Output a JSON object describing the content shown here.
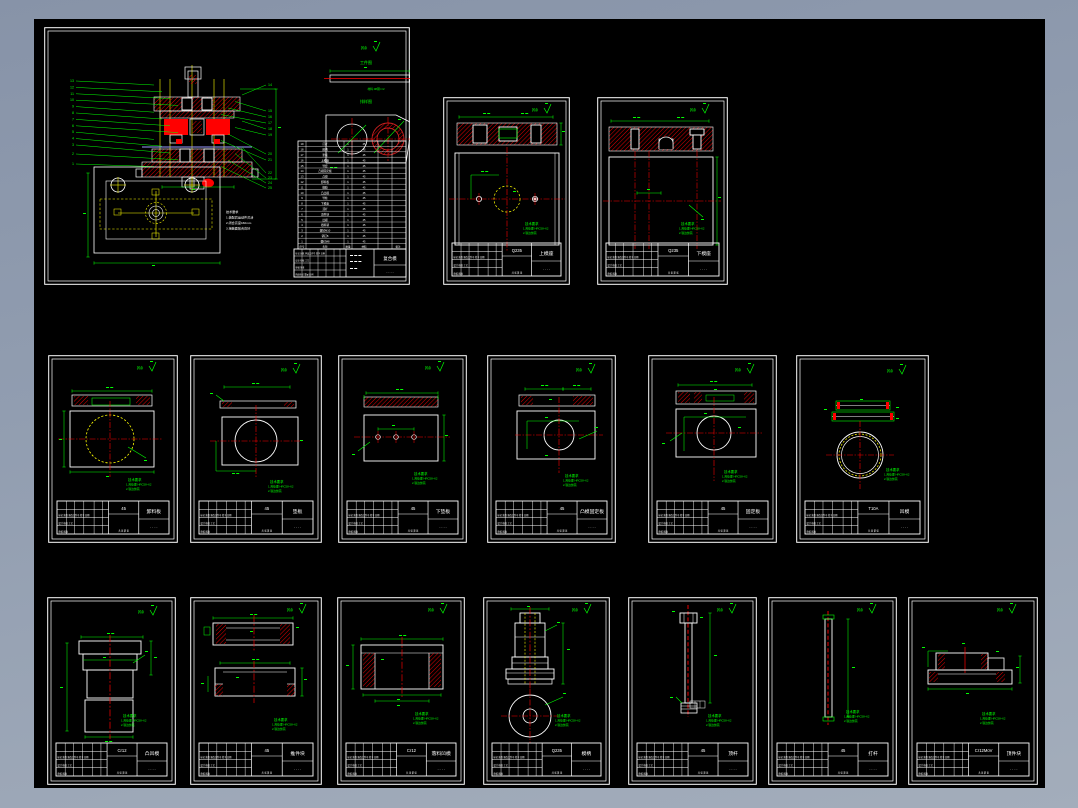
{
  "app": {
    "name": "cad-drawing-preview",
    "background_top": "#8793a8",
    "background_bottom": "#a3adbb",
    "paper_color": "#000000"
  },
  "colors": {
    "line": "#ffffff",
    "dim": "#00ff00",
    "center": "#ff0000",
    "hidden": "#ffff00",
    "strip": "#9b9bff",
    "hatch": "#e00000"
  },
  "common": {
    "roughness": "其余",
    "dots": "· · · ·",
    "notes": [
      "技术要求",
      "1.热处理 HRC58~62",
      "2.锐边倒钝"
    ],
    "tb_rows": [
      "标记 处数 更改文件号 签字 日期",
      "设计  校核  工艺",
      "审核  批准",
      "阶段标记  重量  比例"
    ],
    "sheet_note": "共 张 第 张"
  },
  "assembly": {
    "view_labels": {
      "workpiece": "工件图",
      "layout": "排样图"
    },
    "material_note": "材料:08钢 t=2",
    "tech_notes": [
      "技术要求",
      "1.装配后运动件灵活",
      "2.闭合高度160mm",
      "3.接触面贴合良好"
    ],
    "left_balloons": [
      "13",
      "12",
      "11",
      "10",
      "9",
      "8",
      "7",
      "6",
      "5",
      "4",
      "3",
      "2",
      "1"
    ],
    "right_balloons": [
      "14",
      "15",
      "16",
      "17",
      "18",
      "19",
      "20",
      "21",
      "22",
      "23",
      "24",
      "25"
    ],
    "bom_headers": [
      "序号",
      "名称",
      "数量",
      "材料",
      "备注"
    ],
    "bom_items": [
      "打杆",
      "模柄",
      "垫板",
      "上模座",
      "导套",
      "凸模固定板",
      "凸模",
      "卸料板",
      "橡胶",
      "凸凹模",
      "导柱",
      "下模座",
      "顶杆",
      "顶件块",
      "凹模",
      "挡料销",
      "螺钉M10",
      "销钉8",
      "螺钉M8"
    ],
    "title": {
      "part_name": "复合模",
      "material": ""
    }
  },
  "sheets": [
    {
      "id": "assembly",
      "type": "assembly",
      "x": 44,
      "y": 27,
      "w": 366,
      "h": 258,
      "title": {
        "material": "",
        "part_name": "复合模"
      }
    },
    {
      "id": "upper-die-seat",
      "type": "seatB",
      "x": 443,
      "y": 97,
      "w": 127,
      "h": 188,
      "title": {
        "material": "Q235",
        "part_name": "上模座"
      }
    },
    {
      "id": "lower-die-seat",
      "type": "seatC",
      "x": 597,
      "y": 97,
      "w": 131,
      "h": 188,
      "title": {
        "material": "Q235",
        "part_name": "下模座"
      }
    },
    {
      "id": "stripper-plate",
      "type": "plateDashedCircle",
      "x": 48,
      "y": 355,
      "w": 130,
      "h": 188,
      "title": {
        "material": "45",
        "part_name": "卸料板"
      }
    },
    {
      "id": "upper-pad-plate",
      "type": "plateWhiteCircle",
      "x": 190,
      "y": 355,
      "w": 132,
      "h": 188,
      "title": {
        "material": "45",
        "part_name": "垫板"
      }
    },
    {
      "id": "lower-pad-plate",
      "type": "plateHoles",
      "x": 338,
      "y": 355,
      "w": 129,
      "h": 188,
      "title": {
        "material": "45",
        "part_name": "下垫板"
      }
    },
    {
      "id": "punch-fixing-plate",
      "type": "plateCircleRight",
      "x": 487,
      "y": 355,
      "w": 129,
      "h": 188,
      "title": {
        "material": "45",
        "part_name": "凸模固定板"
      }
    },
    {
      "id": "die-fixing-plate",
      "type": "plateCircleCenter",
      "x": 648,
      "y": 355,
      "w": 129,
      "h": 188,
      "title": {
        "material": "45",
        "part_name": "固定板"
      }
    },
    {
      "id": "die-ring",
      "type": "ring",
      "x": 796,
      "y": 355,
      "w": 133,
      "h": 188,
      "title": {
        "material": "T10A",
        "part_name": "凹模"
      }
    },
    {
      "id": "punch-die",
      "type": "steppedPunch",
      "x": 47,
      "y": 597,
      "w": 129,
      "h": 188,
      "title": {
        "material": "Cr12",
        "part_name": "凸凹模"
      }
    },
    {
      "id": "ejector-block",
      "type": "doubleSection",
      "x": 190,
      "y": 597,
      "w": 132,
      "h": 188,
      "title": {
        "material": "45",
        "part_name": "推件块"
      }
    },
    {
      "id": "blanking-die",
      "type": "bushingSection",
      "x": 337,
      "y": 597,
      "w": 128,
      "h": 188,
      "title": {
        "material": "Cr12",
        "part_name": "落料凹模"
      }
    },
    {
      "id": "die-shank",
      "type": "dieHandle",
      "x": 483,
      "y": 597,
      "w": 127,
      "h": 188,
      "title": {
        "material": "Q235",
        "part_name": "模柄"
      }
    },
    {
      "id": "ejector-rod",
      "type": "flangedRod",
      "x": 628,
      "y": 597,
      "w": 129,
      "h": 188,
      "title": {
        "material": "45",
        "part_name": "顶杆"
      }
    },
    {
      "id": "knockout-rod",
      "type": "plainRod",
      "x": 768,
      "y": 597,
      "w": 129,
      "h": 188,
      "title": {
        "material": "45",
        "part_name": "打杆"
      }
    },
    {
      "id": "locating-flange",
      "type": "flangedSection",
      "x": 908,
      "y": 597,
      "w": 130,
      "h": 188,
      "title": {
        "material": "Cr12MoV",
        "part_name": "顶件块"
      }
    }
  ]
}
